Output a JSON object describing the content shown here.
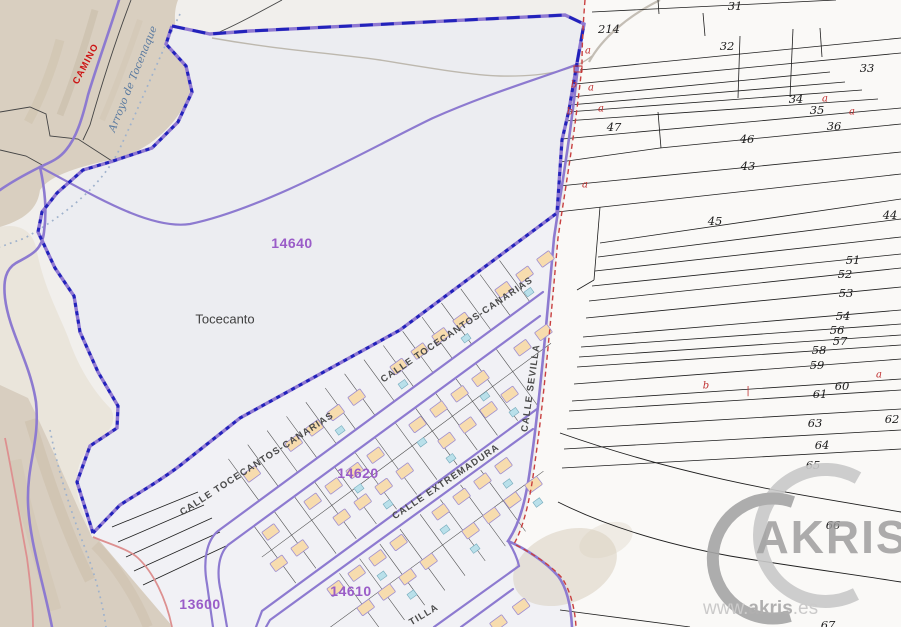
{
  "map": {
    "zone_labels": [
      {
        "text": "14640",
        "x": 292,
        "y": 243
      },
      {
        "text": "14620",
        "x": 358,
        "y": 473
      },
      {
        "text": "14610",
        "x": 351,
        "y": 591
      },
      {
        "text": "13600",
        "x": 200,
        "y": 604
      }
    ],
    "place_labels": [
      {
        "text": "Tocecanto",
        "x": 225,
        "y": 319
      }
    ],
    "street_labels": [
      {
        "text": "CALLE TOCECANTOS-CANARIAS",
        "x": 457,
        "y": 330,
        "rotate": -34
      },
      {
        "text": "CALLE TOCECANTOS-CANARIAS",
        "x": 257,
        "y": 464,
        "rotate": -33
      },
      {
        "text": "CALLE EXTREMADURA",
        "x": 446,
        "y": 482,
        "rotate": -34
      },
      {
        "text": "CALLE SEVILLA",
        "x": 531,
        "y": 388,
        "rotate": -82
      },
      {
        "text": "TILLA",
        "x": 424,
        "y": 615,
        "rotate": -31
      }
    ],
    "nature_labels": [
      {
        "text": "CAMINO",
        "x": 86,
        "y": 64,
        "rotate": -62,
        "class": "camino"
      },
      {
        "text": "Arroyo de Tocenaque",
        "x": 133,
        "y": 79,
        "rotate": -68,
        "class": "arroyo"
      }
    ],
    "parcel_numbers": [
      {
        "text": "31",
        "x": 735,
        "y": 6
      },
      {
        "text": "214",
        "x": 609,
        "y": 29
      },
      {
        "text": "32",
        "x": 727,
        "y": 46
      },
      {
        "text": "33",
        "x": 867,
        "y": 68
      },
      {
        "text": "34",
        "x": 796,
        "y": 99
      },
      {
        "text": "35",
        "x": 817,
        "y": 110
      },
      {
        "text": "36",
        "x": 834,
        "y": 126
      },
      {
        "text": "47",
        "x": 614,
        "y": 127
      },
      {
        "text": "46",
        "x": 747,
        "y": 139
      },
      {
        "text": "43",
        "x": 748,
        "y": 166
      },
      {
        "text": "45",
        "x": 715,
        "y": 221
      },
      {
        "text": "44",
        "x": 890,
        "y": 215
      },
      {
        "text": "51",
        "x": 853,
        "y": 260
      },
      {
        "text": "52",
        "x": 845,
        "y": 274
      },
      {
        "text": "53",
        "x": 846,
        "y": 293
      },
      {
        "text": "54",
        "x": 843,
        "y": 316
      },
      {
        "text": "56",
        "x": 837,
        "y": 330
      },
      {
        "text": "57",
        "x": 840,
        "y": 341
      },
      {
        "text": "58",
        "x": 819,
        "y": 350
      },
      {
        "text": "59",
        "x": 817,
        "y": 365
      },
      {
        "text": "60",
        "x": 842,
        "y": 386
      },
      {
        "text": "61",
        "x": 820,
        "y": 394
      },
      {
        "text": "62",
        "x": 892,
        "y": 419
      },
      {
        "text": "63",
        "x": 815,
        "y": 423
      },
      {
        "text": "64",
        "x": 822,
        "y": 445
      },
      {
        "text": "65",
        "x": 813,
        "y": 465
      },
      {
        "text": "66",
        "x": 833,
        "y": 525
      },
      {
        "text": "67",
        "x": 828,
        "y": 625
      }
    ],
    "ref_marks": [
      {
        "text": "a",
        "x": 588,
        "y": 51
      },
      {
        "text": "b",
        "x": 574,
        "y": 85
      },
      {
        "text": "a",
        "x": 591,
        "y": 88
      },
      {
        "text": "b",
        "x": 570,
        "y": 112
      },
      {
        "text": "a",
        "x": 601,
        "y": 109
      },
      {
        "text": "a",
        "x": 585,
        "y": 185
      },
      {
        "text": "a",
        "x": 825,
        "y": 99
      },
      {
        "text": "a",
        "x": 852,
        "y": 112
      },
      {
        "text": "a",
        "x": 879,
        "y": 375
      },
      {
        "text": "b",
        "x": 706,
        "y": 386
      },
      {
        "text": "|",
        "x": 748,
        "y": 391
      }
    ],
    "watermark": {
      "brand": "AKRIS",
      "url_www": "www.",
      "url_name": "akris",
      "url_tld": ".es"
    },
    "colors": {
      "zone_purple": "#9a5cc8",
      "boundary_blue": "#2222bb",
      "road_purple": "#8d7ad0",
      "boundary_red": "#c94040",
      "house_tan": "#f7dcae",
      "pool_blue": "#b9e0ea"
    }
  }
}
